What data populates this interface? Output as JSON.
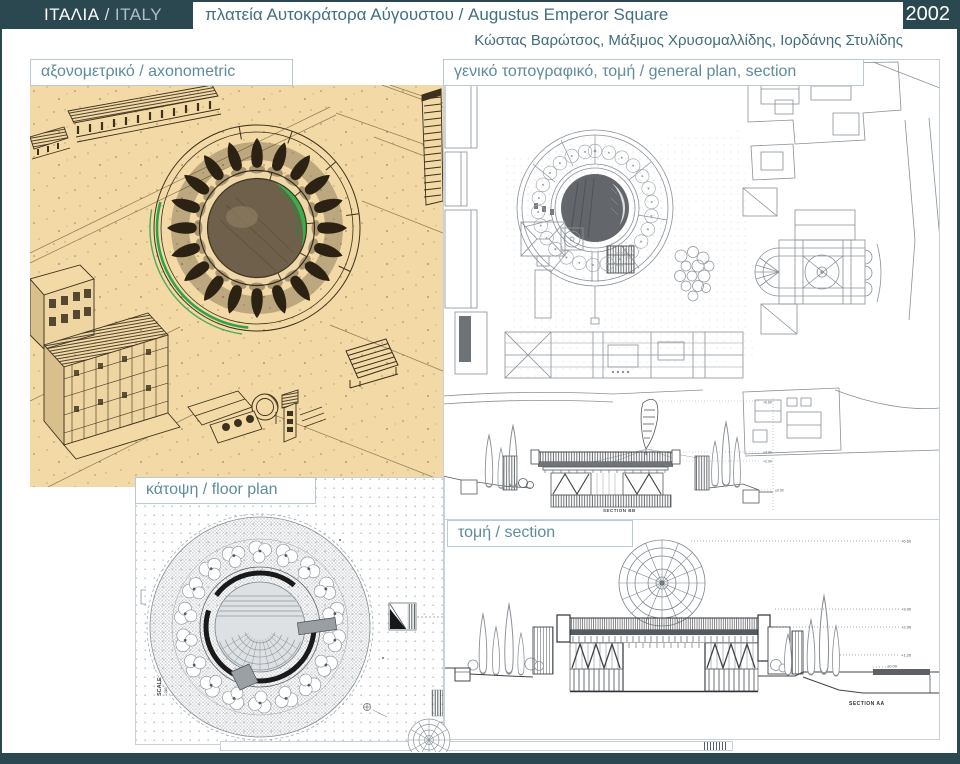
{
  "header": {
    "country_el": "ΙΤΑΛΙΑ",
    "separator": "/",
    "country_en": "ITALY",
    "title": "πλατεία Αυτοκράτορα Αύγουστου / Augustus Emperor Square",
    "year": "2002",
    "credits": "Κώστας Βαρώτσος, Μάξιμος Χρυσομαλλίδης, Ιορδάνης Στυλίδης"
  },
  "panels": {
    "axonometric": {
      "label": "αξονομετρικό / axonometric"
    },
    "general_plan": {
      "label": "γενικό τοπογραφικό, τομή / general plan, section",
      "section_caption": "SECTION BB",
      "elevation_marks": [
        "+6.60",
        "+3.90",
        "+2.90",
        "±0.00"
      ]
    },
    "floor_plan": {
      "label": "κάτοψη / floor plan",
      "scale_label": "SCALE",
      "scale_value": "1:200"
    },
    "section": {
      "label": "τομή / section",
      "section_caption": "SECTION AA",
      "elevation_marks": [
        "+6.60",
        "+3.90",
        "+2.90",
        "+1.20",
        "±0.00"
      ]
    }
  },
  "colors": {
    "header_teal": "#2b4851",
    "accent_text": "#41707e",
    "label_text": "#5f8c9a",
    "label_border": "#b9c9d1",
    "axo_paper": "#f2d9a6",
    "axo_ink": "#3c311e",
    "axo_green": "#35b14b",
    "plan_line": "#8a9199",
    "section_ink": "#3f4347"
  }
}
